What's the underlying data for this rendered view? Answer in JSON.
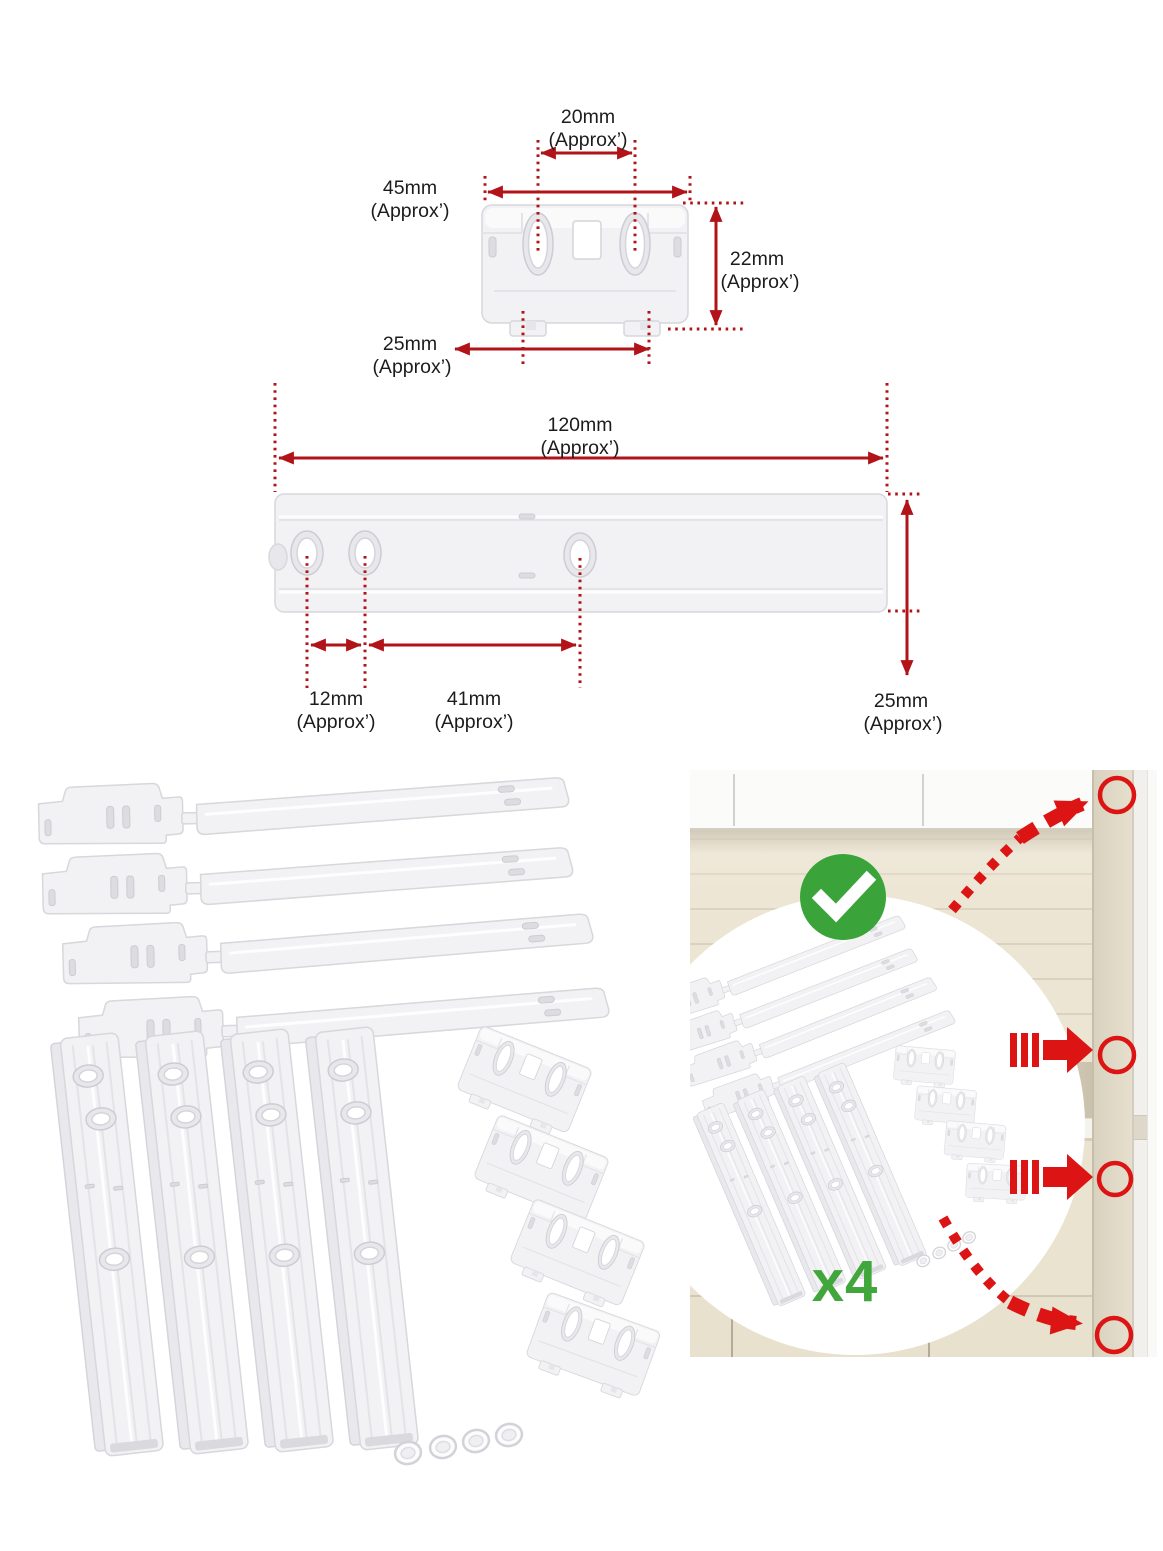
{
  "colors": {
    "dimension_red": "#b11318",
    "overlay_red": "#dd1414",
    "check_green": "#3aa43a",
    "quantity_green": "#41a63c",
    "label_text": "#1c1c1c",
    "part_fill": "#f2f2f4",
    "wall_cream": "#ece5d3",
    "cabinet_white": "#fbfbf9"
  },
  "bracket_diagram": {
    "hole_spacing": {
      "value": "20mm",
      "approx": "(Approx’)"
    },
    "width": {
      "value": "45mm",
      "approx": "(Approx’)"
    },
    "height": {
      "value": "22mm",
      "approx": "(Approx’)"
    },
    "feet_spacing": {
      "value": "25mm",
      "approx": "(Approx’)"
    }
  },
  "rail_diagram": {
    "length": {
      "value": "120mm",
      "approx": "(Approx’)"
    },
    "hole_gap_small": {
      "value": "12mm",
      "approx": "(Approx’)"
    },
    "hole_gap_large": {
      "value": "41mm",
      "approx": "(Approx’)"
    },
    "height": {
      "value": "25mm",
      "approx": "(Approx’)"
    }
  },
  "kit_photo": {
    "quantity_label": "x4",
    "parts_visible": {
      "slider_strips": 4,
      "door_rails": 4,
      "brackets": 4,
      "washers": 4
    }
  },
  "icons": {
    "check-icon": "white checkmark in green circle",
    "corner-marker-circle": "red outlined circle",
    "straight-arrow-icon": "red arrow with speed dashes",
    "curved-arrow-icon": "red dashed curved arrow"
  }
}
